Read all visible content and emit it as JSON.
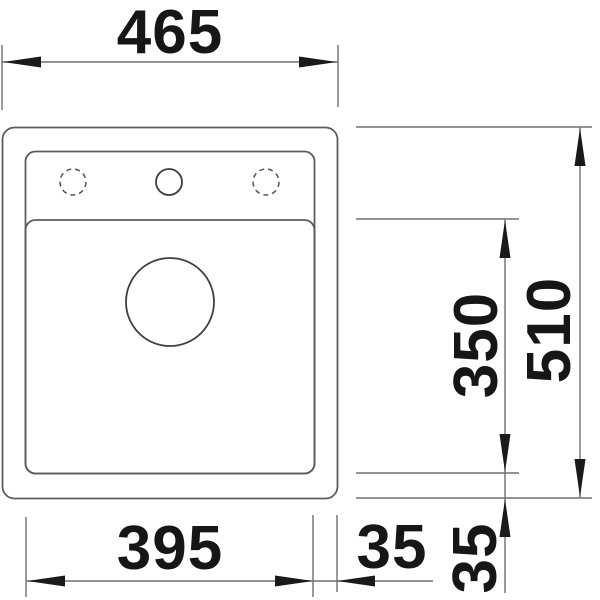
{
  "page": {
    "background": "#ffffff"
  },
  "drawing": {
    "kind": "sink-installation-dimension-drawing",
    "labels": {
      "overall_width_mm": "465",
      "overall_depth_mm": "510",
      "bowl_width_mm": "395",
      "bowl_depth_mm": "350",
      "rim_right_mm": "35",
      "rim_bottom_mm": "35"
    },
    "colors": {
      "outline": "#5c5c5c",
      "dimension_line": "#707070",
      "arrow_and_text": "#1a1a1a"
    }
  }
}
